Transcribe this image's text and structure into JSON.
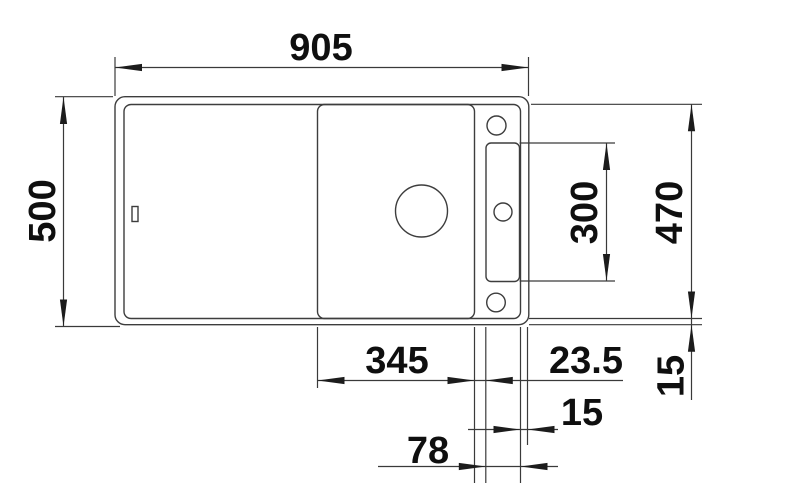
{
  "meta": {
    "drawing_type": "technical-dimension-drawing",
    "subject": "kitchen sink top view",
    "line_color": "#3d3d3d",
    "text_color": "#0f0f0f",
    "background": "#ffffff"
  },
  "dimensions": {
    "overall_width": {
      "label": "905",
      "mm": 905,
      "edge": "top"
    },
    "overall_depth": {
      "label": "500",
      "mm": 500,
      "edge": "left"
    },
    "inner_depth": {
      "label": "470",
      "mm": 470,
      "edge": "right"
    },
    "recess_length": {
      "label": "300",
      "mm": 300,
      "edge": "right"
    },
    "rim_right": {
      "label": "15",
      "mm": 15,
      "edge": "right"
    },
    "board_width": {
      "label": "345",
      "mm": 345,
      "edge": "bottom"
    },
    "board_gap": {
      "label": "23.5",
      "mm": 23.5,
      "edge": "bottom"
    },
    "rim_bottom": {
      "label": "15",
      "mm": 15,
      "edge": "bottom"
    },
    "rail_zone": {
      "label": "78",
      "mm": 78,
      "edge": "bottom"
    }
  }
}
